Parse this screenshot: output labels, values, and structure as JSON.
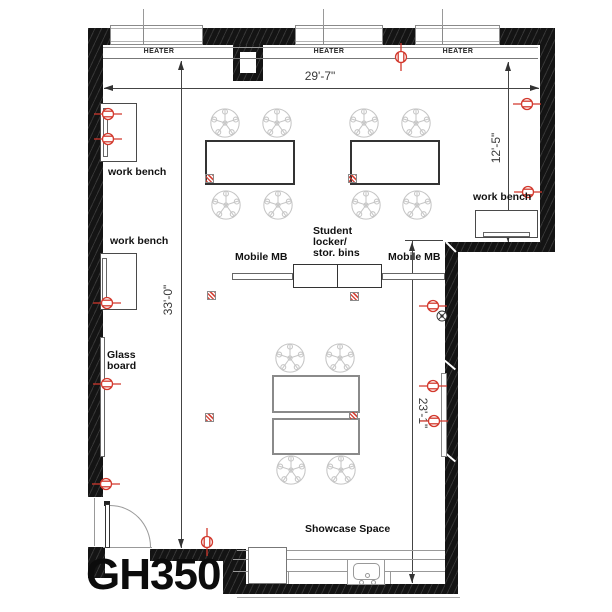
{
  "room": {
    "label": "GH350"
  },
  "heaters": [
    "HEATER",
    "HEATER",
    "HEATER"
  ],
  "dimensions": {
    "top_width": "29'-7\"",
    "left_height": "33'-0\"",
    "right_upper": "12'-5\"",
    "right_lower": "23'-1\""
  },
  "labels": {
    "work_bench_top_left": "work bench",
    "work_bench_mid_left": "work bench",
    "work_bench_right": "work bench",
    "glass_board_line1": "Glass",
    "glass_board_line2": "board",
    "mobile_mb_left": "Mobile MB",
    "mobile_mb_right": "Mobile MB",
    "student_locker_line1": "Student",
    "student_locker_line2": "locker/",
    "student_locker_line3": "stor. bins",
    "showcase_space": "Showcase Space"
  },
  "symbols": {
    "outlet": "duplex-receptacle-icon",
    "floor_box": "floor-power-box-icon",
    "chair": "chair-icon",
    "junction": "junction-box-icon",
    "door": "door-swing"
  },
  "colors": {
    "wall": "#141414",
    "symbol_red": "#d2382c",
    "chair_gray": "#c6c6c6",
    "dim_line": "#444444"
  }
}
